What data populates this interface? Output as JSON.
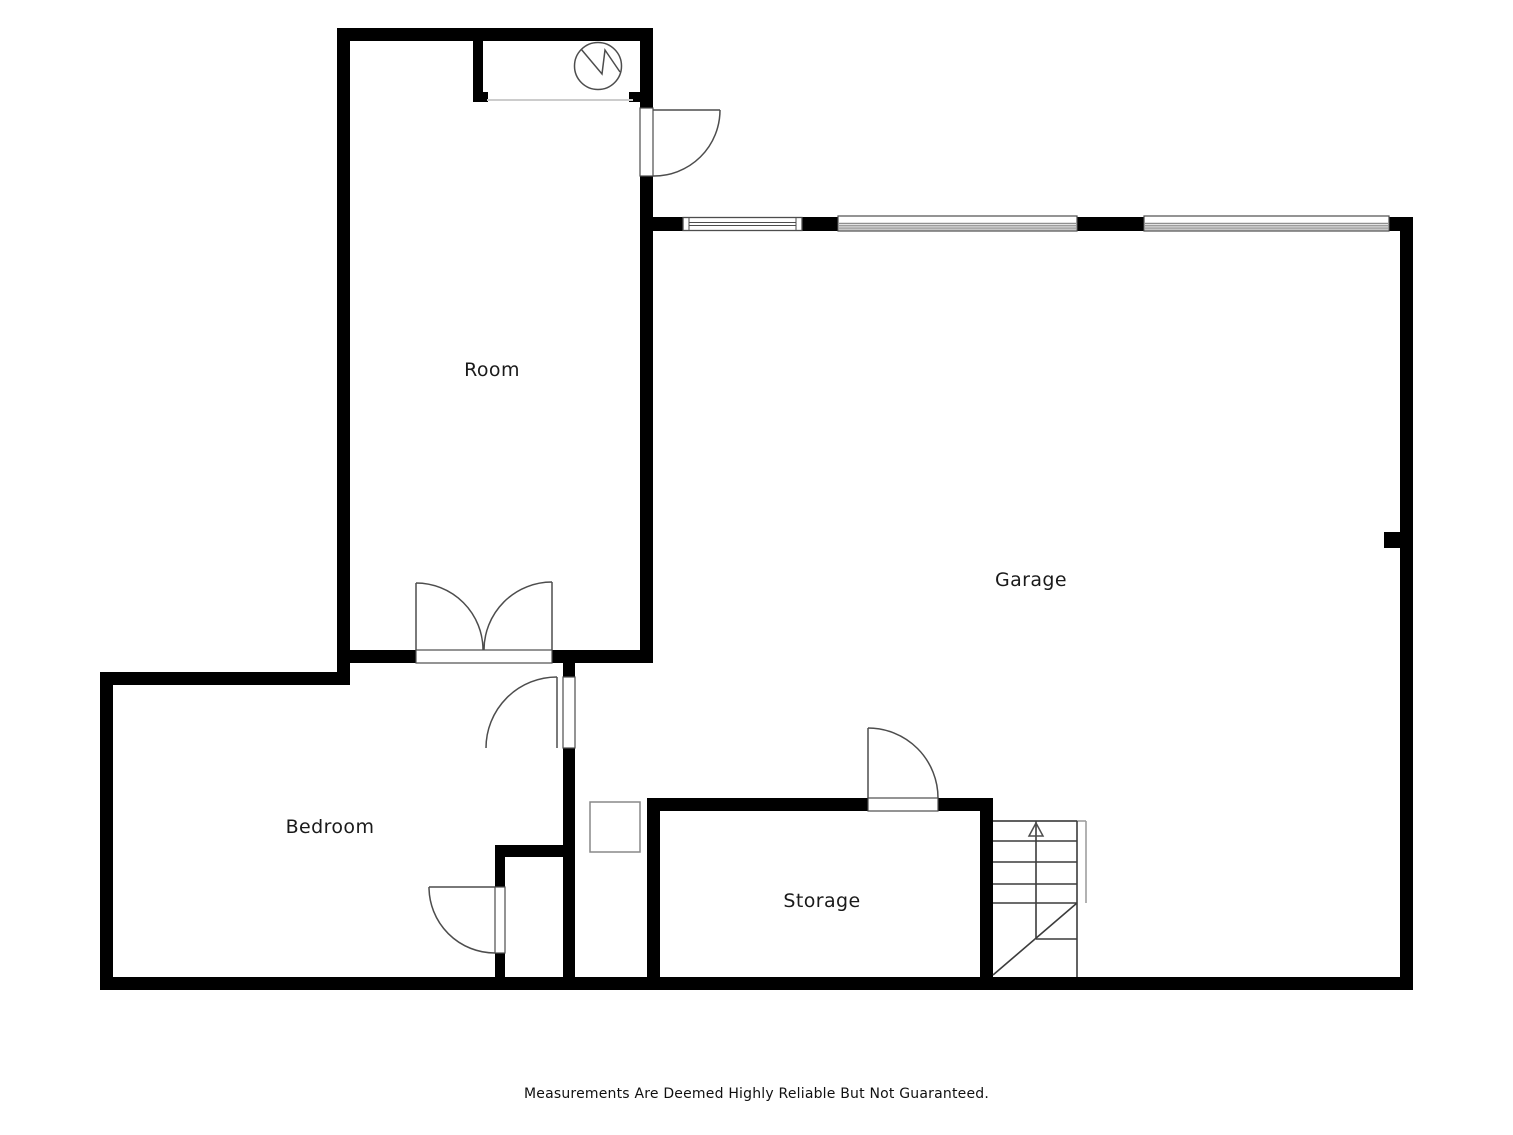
{
  "page": {
    "disclaimer": "Measurements Are Deemed Highly Reliable But Not Guaranteed."
  },
  "floorplan": {
    "rooms": [
      {
        "name": "room",
        "label": "Room"
      },
      {
        "name": "garage",
        "label": "Garage"
      },
      {
        "name": "bedroom",
        "label": "Bedroom"
      },
      {
        "name": "storage",
        "label": "Storage"
      }
    ],
    "symbols": {
      "water_heater": "circle-with-zigzag",
      "stairs_direction": "up-arrow"
    },
    "colors": {
      "wall": "#000000",
      "door": "#4d4d4d",
      "window": "#4d4d4d",
      "stair_line": "#3c3c3c",
      "stair_frame": "#999999",
      "garage_door_stripe": "#8f8f8f",
      "niche_line": "#cccccc",
      "label_text": "#1a1a1a"
    }
  }
}
